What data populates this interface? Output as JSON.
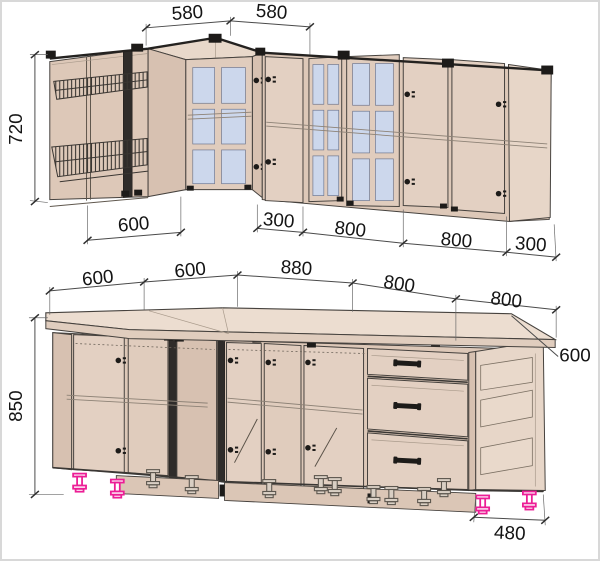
{
  "drawing": {
    "type": "kitchen-cabinet-technical-drawing",
    "units": "mm",
    "upper_cabinets": {
      "corner_widths": [
        "580",
        "580"
      ],
      "height": "720",
      "section_widths": [
        "600",
        "300",
        "800",
        "800",
        "300"
      ]
    },
    "base_cabinets": {
      "section_widths": [
        "600",
        "600",
        "880",
        "800",
        "800"
      ],
      "height": "850",
      "countertop_depth": "600",
      "end_width": "480"
    }
  },
  "colors": {
    "cab-front": "#e3d0c2",
    "cab-side": "#d7c1b1",
    "cab-interior": "#ddc8b8",
    "cab-roof": "#e8d8ca",
    "counter-top": "#ecddd0",
    "counter-front": "#e0cdbe",
    "glass": "#ccd7ec",
    "outline": "#46423e",
    "hardware": "#1d1b19",
    "feet-accent": "#ec1e96",
    "feet-gray": "#5d574f",
    "dim-line": "#4a4a4a",
    "dim-text": "#141414",
    "page-border": "#d8d8d8"
  }
}
